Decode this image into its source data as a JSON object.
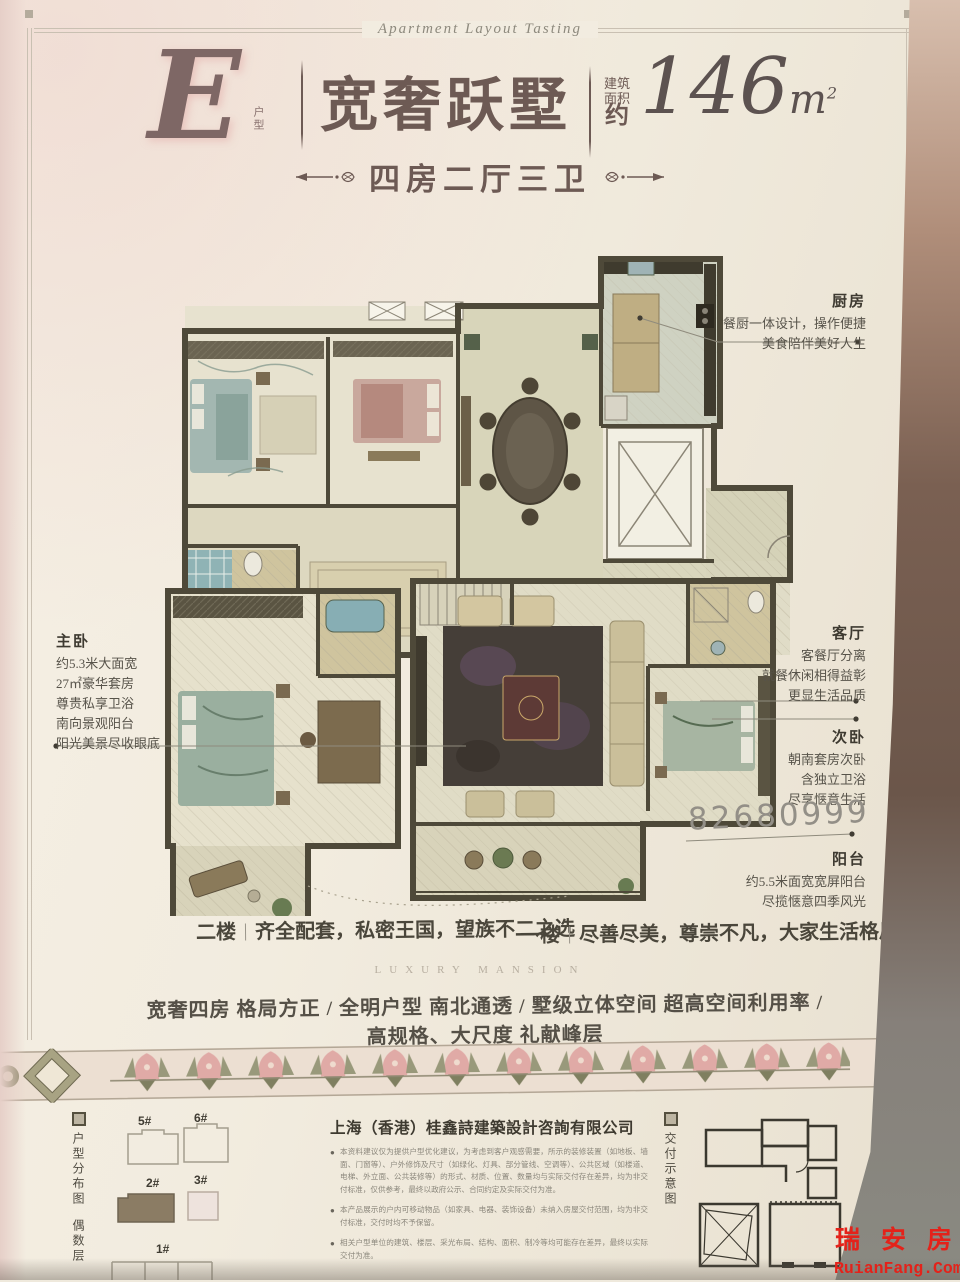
{
  "header": {
    "script_title": "Apartment Layout Tasting",
    "unit_letter": "E",
    "unit_type_label": "户型",
    "main_title": "宽奢跃墅",
    "area_label_line1": "建筑",
    "area_label_line2": "面积",
    "area_approx": "约",
    "area_value": "146",
    "area_unit": "m",
    "area_exponent": "2",
    "subtitle": "四房二厅三卫"
  },
  "annotations": {
    "kitchen": {
      "title": "厨房",
      "lines": [
        "餐厨一体设计，操作便捷",
        "美食陪伴美好人生"
      ]
    },
    "master_bedroom": {
      "title": "主卧",
      "lines": [
        "约5.3米大面宽",
        "27㎡豪华套房",
        "尊贵私享卫浴",
        "南向景观阳台",
        "阳光美景尽收眼底"
      ]
    },
    "living_room": {
      "title": "客厅",
      "lines": [
        "客餐厅分离",
        "就餐休闲相得益彰",
        "更显生活品质"
      ]
    },
    "second_bedroom": {
      "title": "次卧",
      "lines": [
        "朝南套房次卧",
        "含独立卫浴",
        "尽享惬意生活"
      ]
    },
    "balcony": {
      "title": "阳台",
      "lines": [
        "约5.5米面宽宽屏阳台",
        "尽揽惬意四季风光"
      ]
    },
    "phone_number": "82680999"
  },
  "floor_notes": {
    "second_floor_label": "二楼",
    "second_floor_text": "齐全配套，私密王国，望族不二之选",
    "first_floor_label": "一楼",
    "first_floor_text": "尽善尽美，尊崇不凡，大家生活格局"
  },
  "tagline": {
    "english": "LUXURY MANSION",
    "features": "宽奢四房 格局方正 / 全明户型 南北通透 / 墅级立体空间 超高空间利用率 / 高规格、大尺度 礼献峰层"
  },
  "footer": {
    "site_map_label": "户型分布图",
    "site_map_sublabel": "偶数层",
    "building_labels": {
      "b5": "5#",
      "b6": "6#",
      "b2": "2#",
      "b3": "3#",
      "b1": "1#"
    },
    "company": "上海（香港）桂鑫詩建築設計咨詢有限公司",
    "disclaimers": [
      "本资料建议仅为提供户型优化建议，为考虑到客户观感需要，所示的装修装置（如地板、墙面、门窗等）、户外修饰及尺寸（如绿化、灯具、部分管线、空调等）、公共区域（如楼道、电梯、外立面、公共装修等）的形式、材质、位置、数量均与实际交付存在差异，均为非交付标准，仅供参考，最终以政府公示、合同约定及实际交付为准。",
      "本产品展示的户内可移动物品（如家具、电器、装饰设备）未纳入房屋交付范围，均为非交付标准，交付时均不予保留。",
      "相关户型单位的建筑、楼层、采光布局、结构、面积、制冷等均可能存在差异，最终以实际交付为准。"
    ],
    "delivery_label": "交付示意图"
  },
  "watermark": {
    "cn": "瑞 安 房",
    "en": "RuianFang.Com",
    "color": "#e4221a"
  },
  "colors": {
    "title": "#6d5a54",
    "wall": "#4e4939",
    "accent_pink": "#e0aaa6",
    "accent_olive": "#8a8a68",
    "phone_gray": "#938f87"
  }
}
